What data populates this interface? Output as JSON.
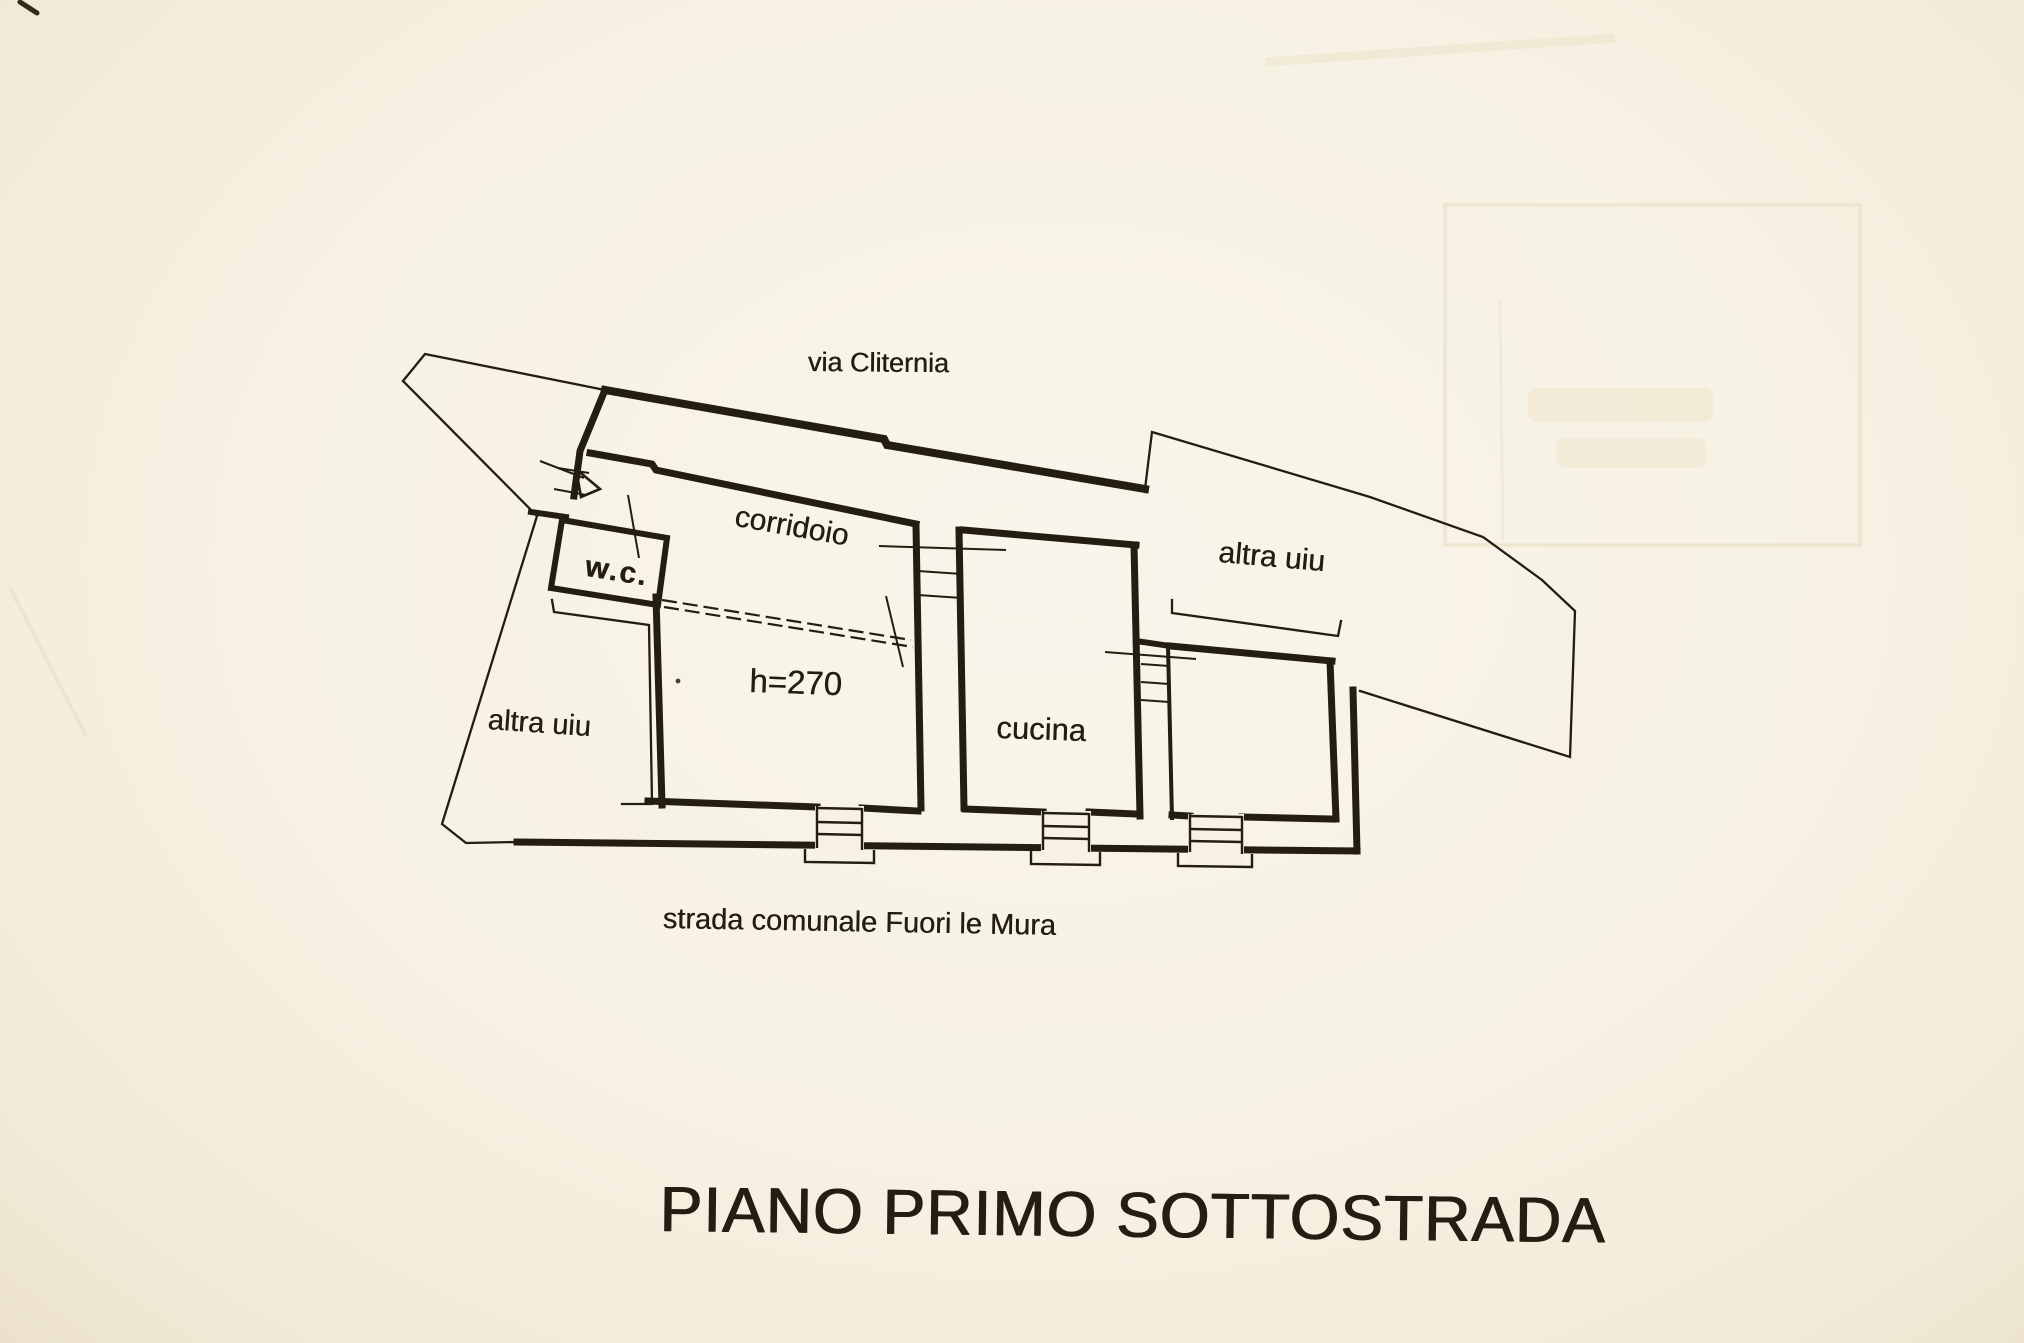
{
  "document": {
    "kind_label": "scanned cadastral floor plan",
    "title": "PIANO PRIMO SOTTOSTRADA",
    "street_top": "via Cliternia",
    "street_bottom": "strada comunale Fuori le Mura"
  },
  "rooms": {
    "corridor": "corridoio",
    "wc": "w.c.",
    "other_unit_left": "altra uiu",
    "other_unit_right": "altra uiu",
    "kitchen": "cucina",
    "height_note": "h=270"
  },
  "colors": {
    "ink": "#241d12",
    "paper": "#f6f1e3",
    "bleed": "#eadfc4"
  }
}
